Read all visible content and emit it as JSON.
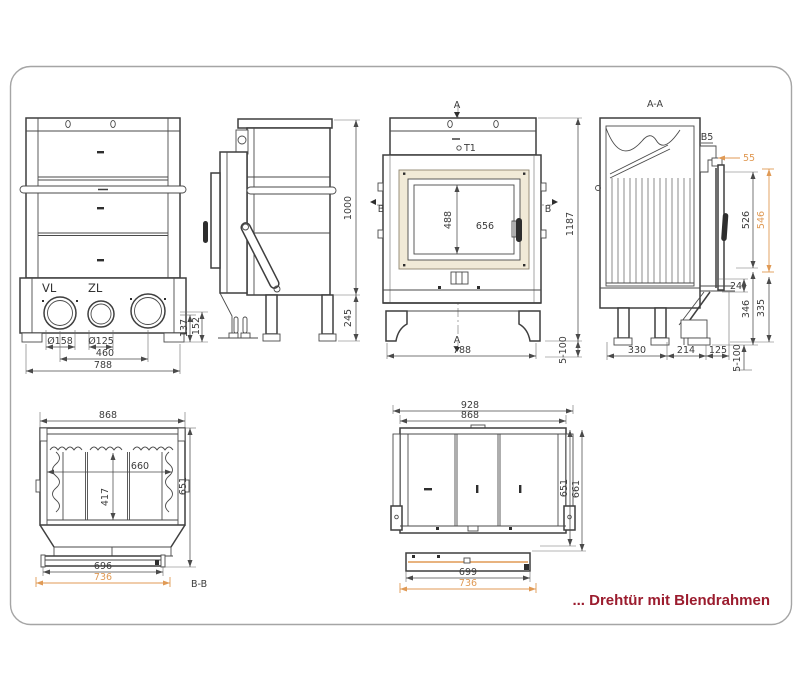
{
  "caption": {
    "text": "... Drehtür mit Blendrahmen"
  },
  "colors": {
    "line": "#4a4a4a",
    "accent": "#e09a55",
    "caption": "#9b1c2e",
    "frame_fill": "#f1ead7"
  },
  "rear": {
    "vl": "VL",
    "zl": "ZL",
    "d158": "Ø158",
    "d125": "Ø125",
    "d460": "460",
    "d788": "788",
    "d137": "137",
    "d152": "152"
  },
  "side": {
    "d1000": "1000",
    "d245": "245"
  },
  "front": {
    "a": "A",
    "a2": "A",
    "t1": "T1",
    "b_l": "B",
    "b_r": "B",
    "d488": "488",
    "d656": "656",
    "d1187": "1187",
    "d788": "788",
    "d5100": "5-100"
  },
  "aa": {
    "title": "A-A",
    "b5": "B5",
    "d55": "55",
    "d526": "526",
    "d546": "546",
    "d24": "24",
    "d335": "335",
    "d346": "346",
    "d330": "330",
    "d214": "214",
    "d125": "125",
    "d5100": "5-100"
  },
  "bb": {
    "title": "B-B",
    "d868": "868",
    "d660": "660",
    "d417": "417",
    "d651": "651",
    "d696": "696",
    "d736": "736"
  },
  "plan": {
    "d928": "928",
    "d868": "868",
    "d651": "651",
    "d661": "661",
    "d699": "699",
    "d736": "736"
  }
}
